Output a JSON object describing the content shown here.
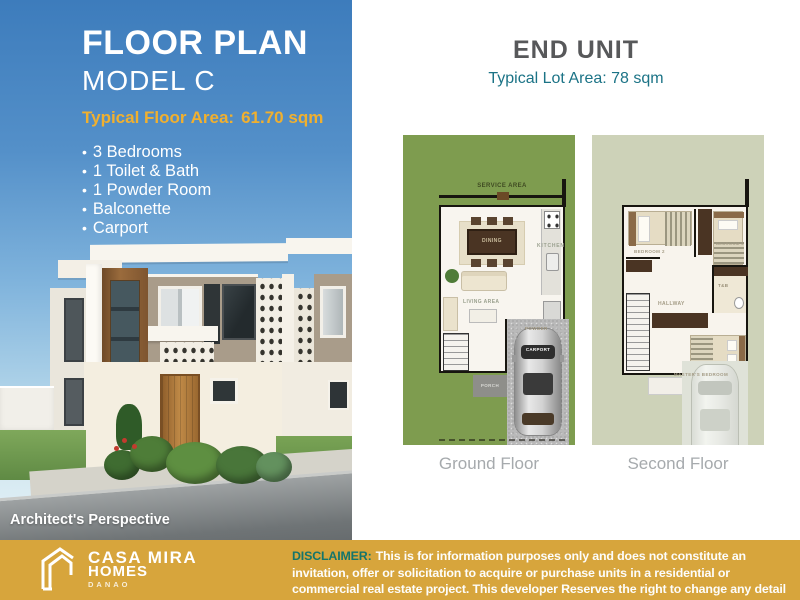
{
  "left_panel": {
    "title": "FLOOR PLAN",
    "model": "MODEL C",
    "floor_area_label": "Typical Floor Area:",
    "floor_area_value": "61.70 sqm",
    "bullet": "•",
    "features": [
      "3 Bedrooms",
      "1 Toilet & Bath",
      "1 Powder Room",
      "Balconette",
      "Carport"
    ],
    "caption": "Architect's Perspective"
  },
  "right_panel": {
    "title": "END UNIT",
    "subtitle": "Typical Lot Area: 78 sqm",
    "ground_floor": {
      "label": "Ground Floor",
      "service_area": "SERVICE AREA",
      "dining": "DINING",
      "kitchen": "KITCHEN",
      "living_area": "LIVING AREA",
      "powder": "POWDER",
      "porch": "PORCH",
      "carport": "CARPORT"
    },
    "second_floor": {
      "label": "Second Floor",
      "bedroom2": "BEDROOM 2",
      "bedroom3": "BEDROOM 3",
      "hallway": "HALLWAY",
      "toilet_bath": "T&B",
      "master_bedroom": "MASTER'S BEDROOM"
    }
  },
  "footer": {
    "brand_name": "CASA MIRA",
    "brand_sub": "HOMES",
    "brand_location": "DANAO",
    "disclaimer_label": "DISCLAIMER:",
    "disclaimer_text": "This is for information purposes only and does not constitute an invitation, offer or solicitation to acquire or purchase units in a residential or commercial real estate project. This developer Reserves the right to change any detail herein without prior notice."
  },
  "colors": {
    "accent_gold": "#F0B02F",
    "footer_bg": "#D7A53C",
    "subtitle_teal": "#1B7386",
    "disclaimer_teal": "#15756B",
    "lawn_green": "#7E9C4F",
    "sage_green": "#CDD2B8"
  }
}
